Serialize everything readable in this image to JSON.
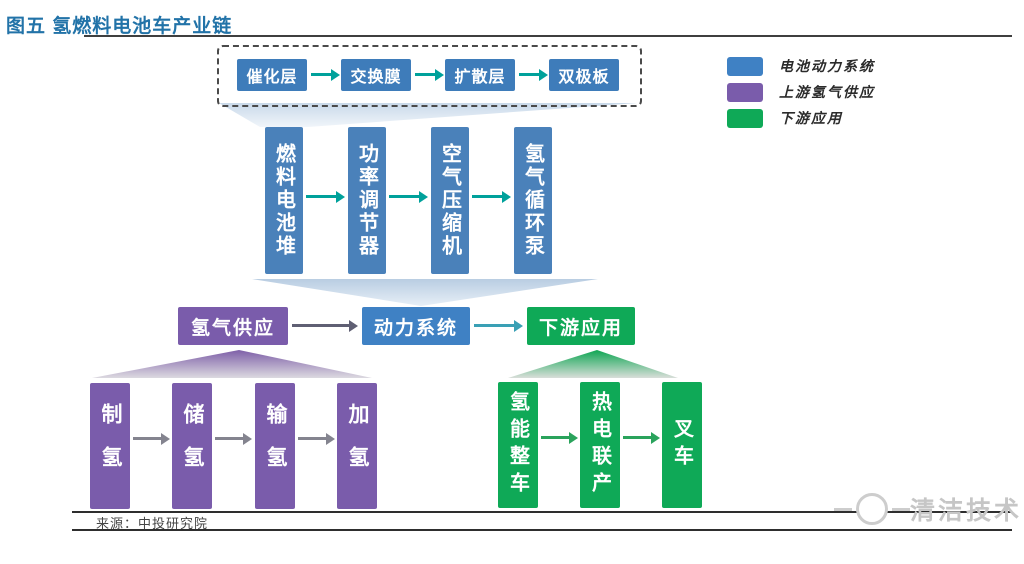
{
  "title": "图五 氢燃料电池车产业链",
  "legend": {
    "items": [
      {
        "label": "电池动力系统",
        "color": "#4f86c2"
      },
      {
        "label": "上游氢气供应",
        "color": "#7b5fad"
      },
      {
        "label": "下游应用",
        "color": "#0caa55"
      }
    ]
  },
  "membrane_electrode": {
    "nodes": [
      "催化层",
      "交换膜",
      "扩散层",
      "双极板"
    ]
  },
  "power_system": {
    "nodes": [
      "燃料电池堆",
      "功率调节器",
      "空气压缩机",
      "氢气循环泵"
    ]
  },
  "main_chain": {
    "nodes": [
      "氢气供应",
      "动力系统",
      "下游应用"
    ]
  },
  "hydrogen_supply": {
    "nodes": [
      "制氢",
      "储氢",
      "输氢",
      "加氢"
    ]
  },
  "downstream": {
    "nodes": [
      "氢能整车",
      "热电联产",
      "叉车"
    ]
  },
  "source_note": "来源：中投研究院",
  "watermark": "清洁技术",
  "colors": {
    "box_blue": "#3e7cba",
    "box_mid_blue": "#3f81c4",
    "box_purple": "#7a5cab",
    "box_green": "#0fa957",
    "teal_arrow": "#00a19b",
    "gray_arrow": "#84848f",
    "dark_gray_arrow": "#5f5f73",
    "green_arrow": "#2aa35c",
    "teal_blue_arrow": "#3aa0b5",
    "title_blue": "#2273a8"
  },
  "icons": {
    "arrow_right": "→"
  }
}
